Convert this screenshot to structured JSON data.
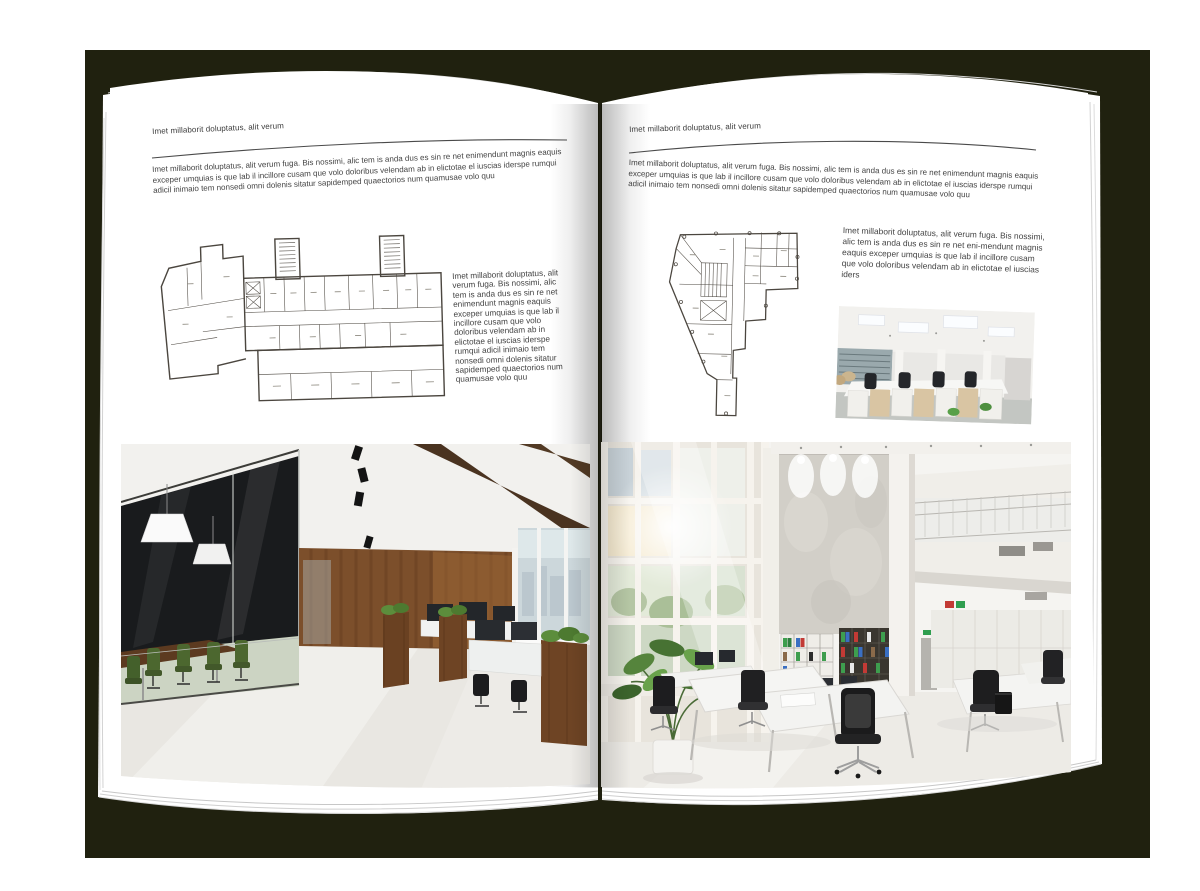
{
  "palette": {
    "backdrop": "#20210f",
    "page": "#ffffff",
    "body_text": "#434343",
    "rule_line": "#4a4a4a",
    "plan_line": "#4b463f",
    "wood_wall": "#7c4f2b",
    "chair_green": "#4c672f",
    "binder_green": "#3e9e4e",
    "binder_blue": "#3a6fc2",
    "binder_red": "#c23a35"
  },
  "left_page": {
    "header": "Imet millaborit doluptatus, alit verum",
    "intro": "Imet millaborit doluptatus, alit verum fuga. Bis nossimi, alic tem is anda dus es sin re net enimendunt magnis eaquis exceper umquias is que lab il incillore cusam que volo doloribus velendam ab in elictotae el iuscias iderspe rumqui adicil inimaio tem nonsedi omni dolenis sitatur sapidemped quaectorios num quamusae volo quu",
    "side_text": "Imet millaborit doluptatus, alit verum fuga. Bis nossimi, alic tem is anda dus es sin re net enimendunt magnis eaquis exceper umquias is que lab il incillore cusam que volo doloribus velendam ab in elictotae el iuscias iderspe rumqui adicil inimaio tem nonsedi omni dolenis sitatur sapidemped quaectorios num quamusae volo quu",
    "floor_plan": "long office block floor plan with two stair towers and angled left wing",
    "photo": "office interior: dark glass meeting room with green chairs, walnut wall, wooden planters and workstations"
  },
  "right_page": {
    "header": "Imet millaborit doluptatus, alit verum",
    "intro": "Imet millaborit doluptatus, alit verum fuga. Bis nossimi, alic tem is anda dus es sin re net enimendunt magnis eaquis exceper umquias is que lab il incillore cusam que volo doloribus velendam ab in elictotae el iuscias iderspe rumqui adicil inimaio tem nonsedi omni dolenis sitatur sapidemped quaectorios num quamusae volo quu",
    "side_text": "Imet millaborit doluptatus, alit verum fuga. Bis nossimi, alic tem is anda dus es sin re net eni-mendunt magnis eaquis exceper umquias is que lab il incillore cusam que volo doloribus velendam ab in elictotae el iuscias iders",
    "floor_plan": "irregular corner building floor plan with central core and bottom stub",
    "photo_small": "open plan office with pale wood pedestals, black task chairs and panel ceiling lights",
    "photo_large": "bright double-height office atrium with window wall, concrete wall, binder shelves and white desks"
  }
}
